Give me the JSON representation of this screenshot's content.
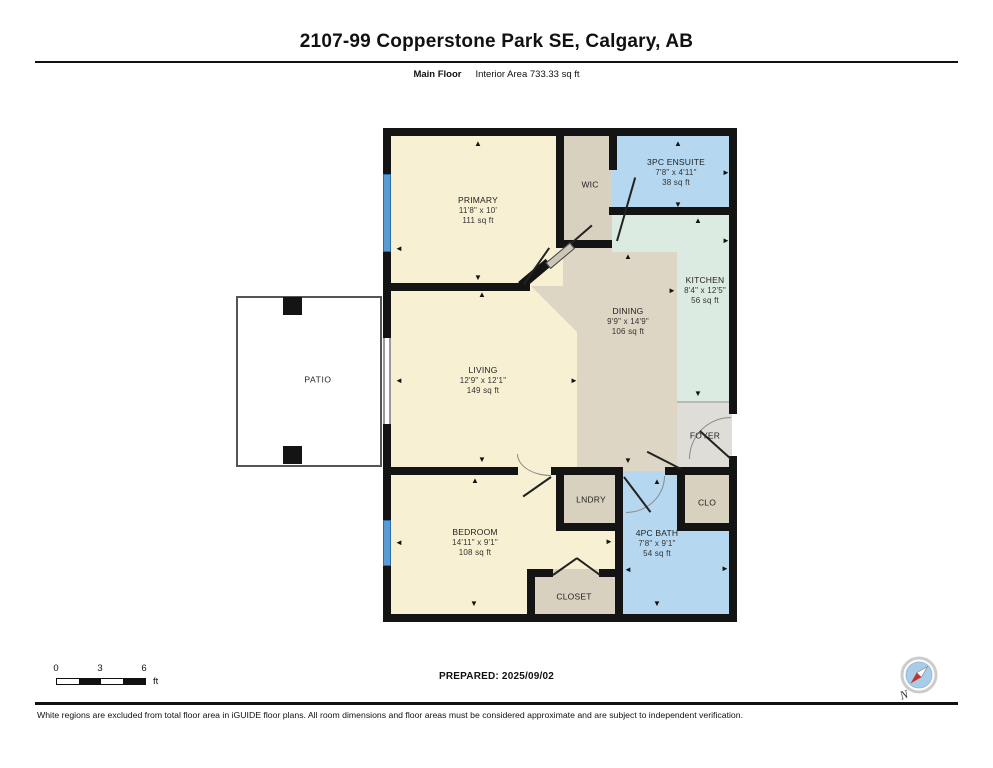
{
  "header": {
    "title": "2107-99 Copperstone Park SE, Calgary, AB",
    "floor_label": "Main Floor",
    "area_label": "Interior Area 733.33 sq ft"
  },
  "rooms": {
    "primary": {
      "name": "PRIMARY",
      "dims": "11'8\" x 10'",
      "area": "111 sq ft"
    },
    "wic": {
      "name": "WIC"
    },
    "ensuite": {
      "name": "3PC ENSUITE",
      "dims": "7'8\" x 4'11\"",
      "area": "38 sq ft"
    },
    "kitchen": {
      "name": "KITCHEN",
      "dims": "8'4\" x 12'5\"",
      "area": "56 sq ft"
    },
    "dining": {
      "name": "DINING",
      "dims": "9'9\" x 14'9\"",
      "area": "106 sq ft"
    },
    "living": {
      "name": "LIVING",
      "dims": "12'9\" x 12'1\"",
      "area": "149 sq ft"
    },
    "patio": {
      "name": "PATIO"
    },
    "foyer": {
      "name": "FOYER"
    },
    "laundry": {
      "name": "LNDRY"
    },
    "clo": {
      "name": "CLO"
    },
    "bedroom": {
      "name": "BEDROOM",
      "dims": "14'11\" x 9'1\"",
      "area": "108 sq ft"
    },
    "bath": {
      "name": "4PC BATH",
      "dims": "7'8\" x 9'1\"",
      "area": "54 sq ft"
    },
    "closet": {
      "name": "CLOSET"
    }
  },
  "footer": {
    "scale_ticks": [
      "0",
      "3",
      "6"
    ],
    "scale_unit": "ft",
    "prepared": "PREPARED: 2025/09/02",
    "disclaimer": "White regions are excluded from total floor area in iGUIDE floor plans. All room dimensions and floor areas must be considered approximate and are subject to independent verification.",
    "compass_label": "N"
  },
  "colors": {
    "cream": "#f7f0d2",
    "tan": "#d8d1c0",
    "dining": "#ddd6c5",
    "blue": "#b5d8f0",
    "green": "#dcebe1",
    "foyer": "#dfddd8",
    "window": "#5b9bd5",
    "wall": "#141414",
    "compass_needle": "#c92f2f"
  }
}
